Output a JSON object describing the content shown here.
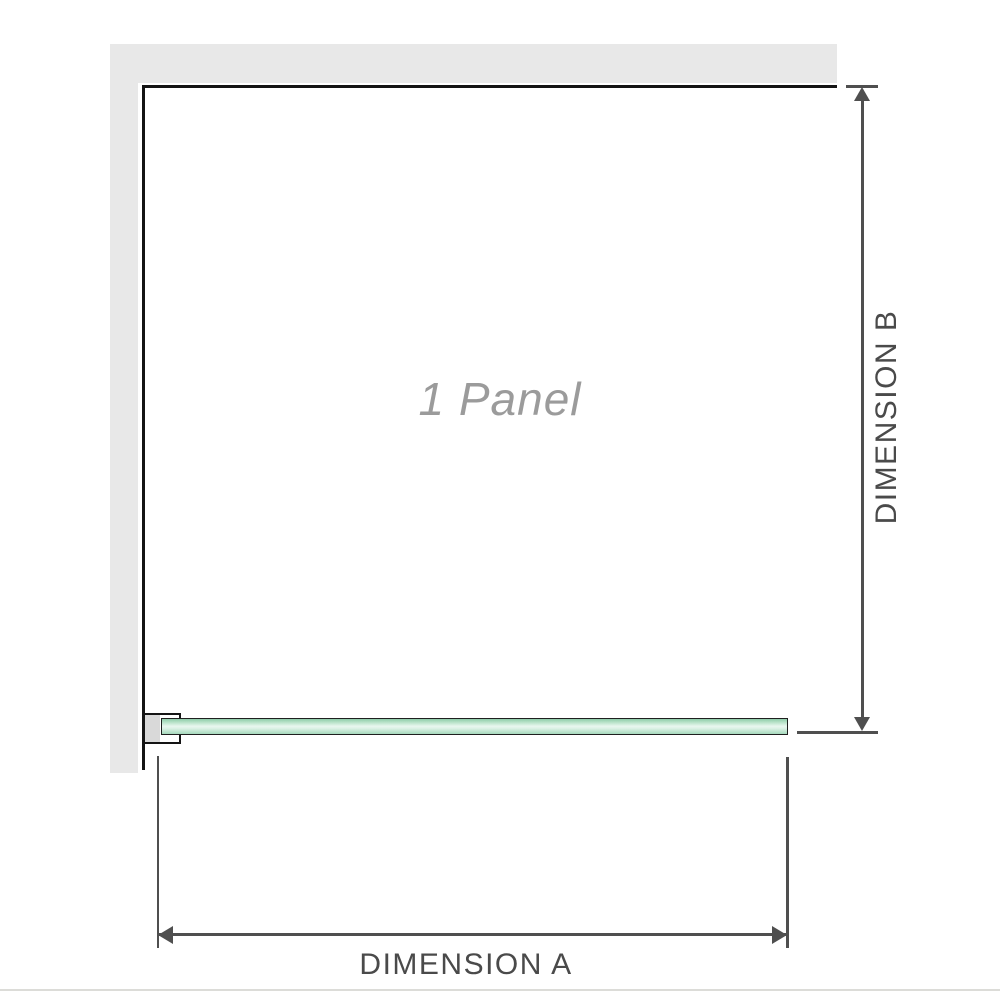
{
  "diagram": {
    "labels": {
      "panel": "1 Panel",
      "dimension_a": "DIMENSION A",
      "dimension_b": "DIMENSION B"
    },
    "colors": {
      "background": "#ffffff",
      "wall_gray": "#e8e8e8",
      "panel_outline_black": "#141414",
      "dimension_gray": "#4f4f4f",
      "dimension_text_gray": "#4a4a4a",
      "panel_label_gray": "#9b9b9b",
      "glass_outline": "#1f1f1f",
      "glass_green_edge": "#8fcca9",
      "glass_green_center": "#e9f7ef",
      "bracket_fill_gray": "#d9d9d9",
      "footer_rule_gray": "#dcdcd8"
    }
  }
}
